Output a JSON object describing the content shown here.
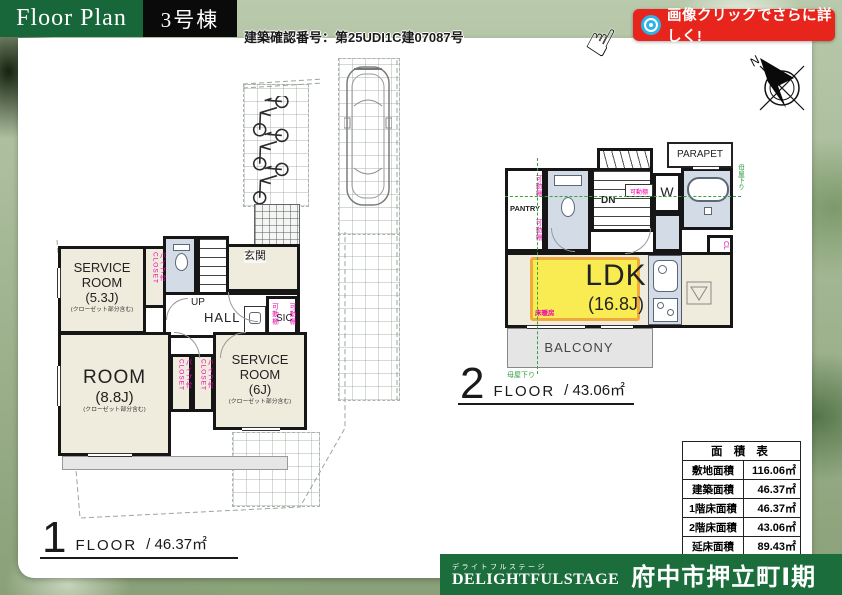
{
  "header": {
    "title": "Floor Plan",
    "unit": "3号棟",
    "confirmation": "建築確認番号：第25UDI1C建07087号"
  },
  "cta": {
    "label": "画像クリックでさらに詳しく!"
  },
  "compass": {
    "north": "N"
  },
  "colors": {
    "brand_green": "#17673a",
    "badge_red": "#e7251c",
    "accent_pink": "#ee00ae",
    "floor_heat_yellow": "#f8ec52",
    "annotation_green": "#2f9e3f"
  },
  "floor1": {
    "caption": {
      "num": "1",
      "floor_label": "FLOOR",
      "area": "/ 46.37㎡"
    },
    "rooms": {
      "service_room_a": {
        "name": "SERVICE ROOM",
        "size": "(5.3J)",
        "note": "(クローゼット部分含む)"
      },
      "room": {
        "name": "ROOM",
        "size": "(8.8J)",
        "note": "(クローゼット部分含む)"
      },
      "service_room_b": {
        "name": "SERVICE ROOM",
        "size": "(6J)",
        "note": "(クローゼット部分含む)"
      },
      "entrance": "玄関",
      "up": "UP",
      "hall": "HALL",
      "sic": "SIC",
      "closet_a": "パイプ付CLOSET",
      "closet_b": "パイプ付CLOSET",
      "closet_c": "パイプ付CLOSET",
      "shelf_l": "可動棚",
      "shelf_r": "可動棚"
    }
  },
  "floor2": {
    "caption": {
      "num": "2",
      "floor_label": "FLOOR",
      "area": "/ 43.06㎡"
    },
    "rooms": {
      "ldk_name": "LDK",
      "ldk_size": "(16.8J)",
      "pantry": "PANTRY",
      "parapet": "PARAPET",
      "balcony": "BALCONY",
      "dn": "DN",
      "washer": "W",
      "fridge": "R",
      "cl": "CL",
      "floor_heating": "床暖房",
      "shelf_a": "可動棚",
      "shelf_b": "可動棚",
      "shelf_c": "可動棚",
      "eaves_right": "母屋下り",
      "eaves_bottom": "母屋下り"
    }
  },
  "area_table": {
    "title": "面 積 表",
    "rows": [
      {
        "label": "敷地面積",
        "value": "116.06㎡"
      },
      {
        "label": "建築面積",
        "value": "46.37㎡"
      },
      {
        "label": "1階床面積",
        "value": "46.37㎡"
      },
      {
        "label": "2階床面積",
        "value": "43.06㎡"
      },
      {
        "label": "延床面積",
        "value": "89.43㎡"
      }
    ]
  },
  "footer": {
    "brand_kana": "デライトフルステージ",
    "brand_en": "DELIGHTFULSTAGE",
    "project": "府中市押立町Ⅰ期"
  }
}
